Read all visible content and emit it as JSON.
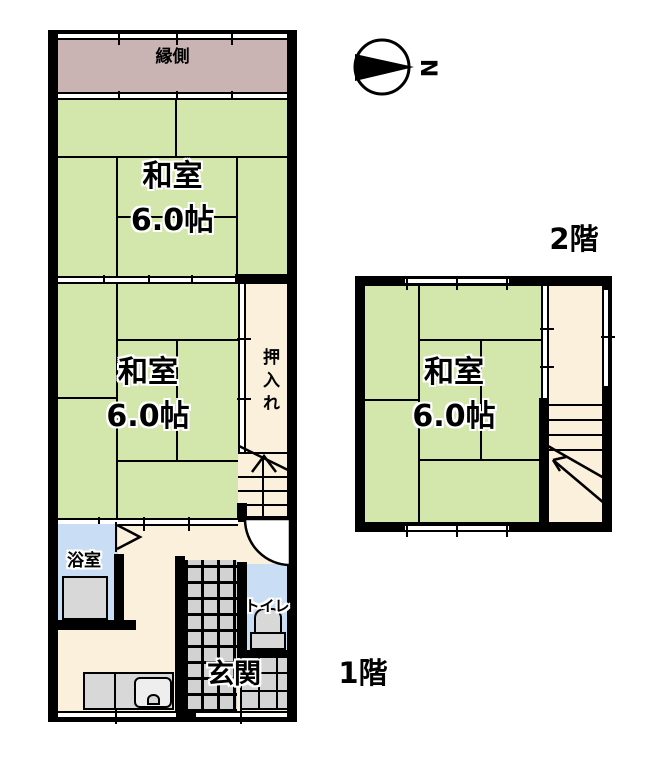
{
  "floorplan": {
    "floor_labels": {
      "first": "1階",
      "second": "2階"
    },
    "compass": {
      "north": "N"
    },
    "rooms": {
      "engawa": {
        "label": "縁側"
      },
      "washitsu_1f_front": {
        "label": "和室",
        "size": "6.0帖"
      },
      "washitsu_1f_back": {
        "label": "和室",
        "size": "6.0帖"
      },
      "oshiire": {
        "label": "押入れ"
      },
      "bathroom": {
        "label": "浴室"
      },
      "toilet": {
        "label": "トイレ"
      },
      "genkan": {
        "label": "玄関"
      },
      "washitsu_2f": {
        "label": "和室",
        "size": "6.0帖"
      }
    },
    "colors": {
      "tatami_green": "#d3e7ad",
      "engawa_mauve": "#c9b3b3",
      "closet_cream": "#faf0dc",
      "water_blue": "#c9ddf5",
      "fixture_gray": "#d8d8d8",
      "wall_black": "#000000"
    }
  }
}
